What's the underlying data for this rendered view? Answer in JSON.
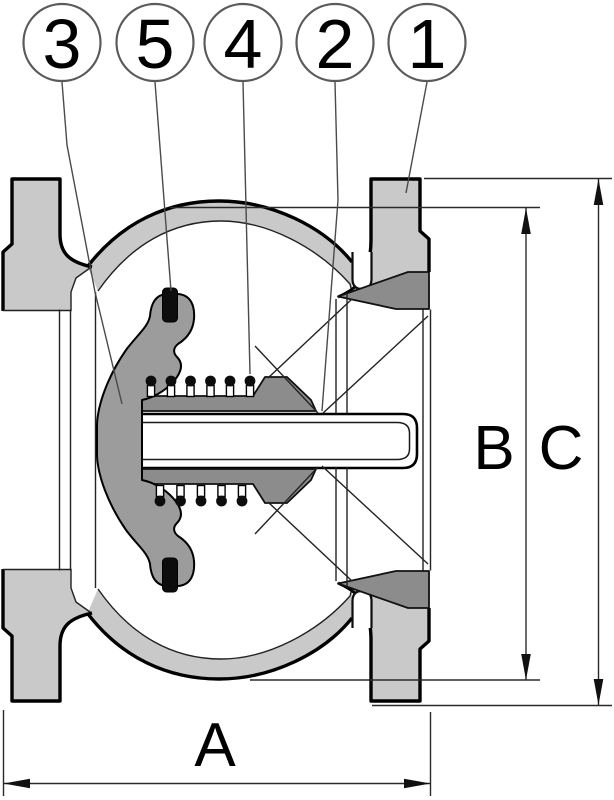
{
  "diagram": {
    "type": "technical-drawing",
    "subject": "spring-loaded check valve cross-section",
    "callouts": [
      {
        "label": "3"
      },
      {
        "label": "5"
      },
      {
        "label": "4"
      },
      {
        "label": "2"
      },
      {
        "label": "1"
      }
    ],
    "dimensions": [
      {
        "label": "A",
        "axis": "horizontal"
      },
      {
        "label": "B",
        "axis": "vertical"
      },
      {
        "label": "C",
        "axis": "vertical"
      }
    ],
    "colors": {
      "body": "#c9c9c9",
      "disc": "#9c9c9c",
      "hardware": "#8c8c8c",
      "pin": "#0d0d0d",
      "outline": "#000000",
      "dimension_lines": "#2a2a2a",
      "leader_lines": "#4a4a4a",
      "background": "#ffffff"
    }
  }
}
